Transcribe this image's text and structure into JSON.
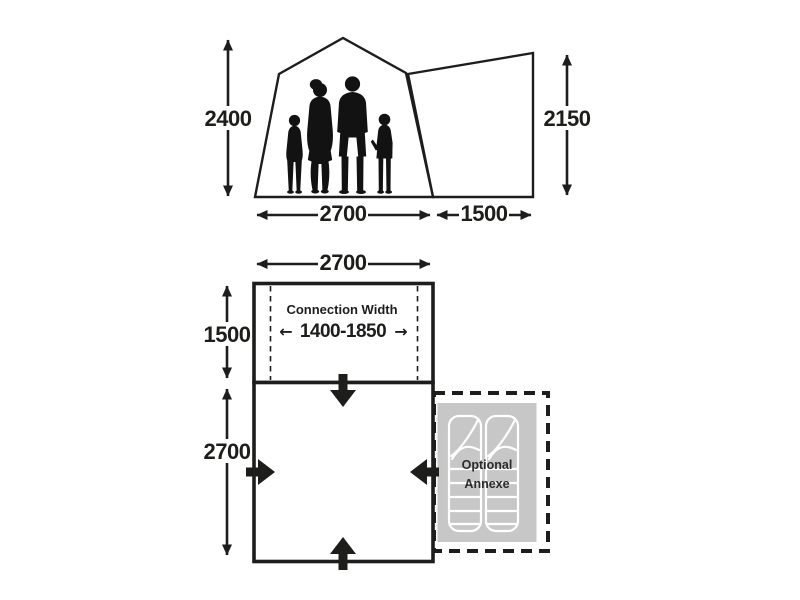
{
  "colors": {
    "ink": "#1d1d1b",
    "background": "#ffffff",
    "silhouette": "#121212",
    "annexe_fill": "#c7c7c7",
    "bag_line": "#ffffff"
  },
  "elevation": {
    "height_main": "2400",
    "height_annexe": "2150",
    "width_main": "2700",
    "width_annexe": "1500"
  },
  "floorplan": {
    "width_top": "2700",
    "depth_connection": "1500",
    "depth_main": "2700",
    "connection": {
      "label": "Connection Width",
      "range": "1400-1850",
      "arrow_left_glyph": "←",
      "arrow_right_glyph": "→"
    },
    "annexe": {
      "label_line1": "Optional",
      "label_line2": "Annexe"
    }
  }
}
